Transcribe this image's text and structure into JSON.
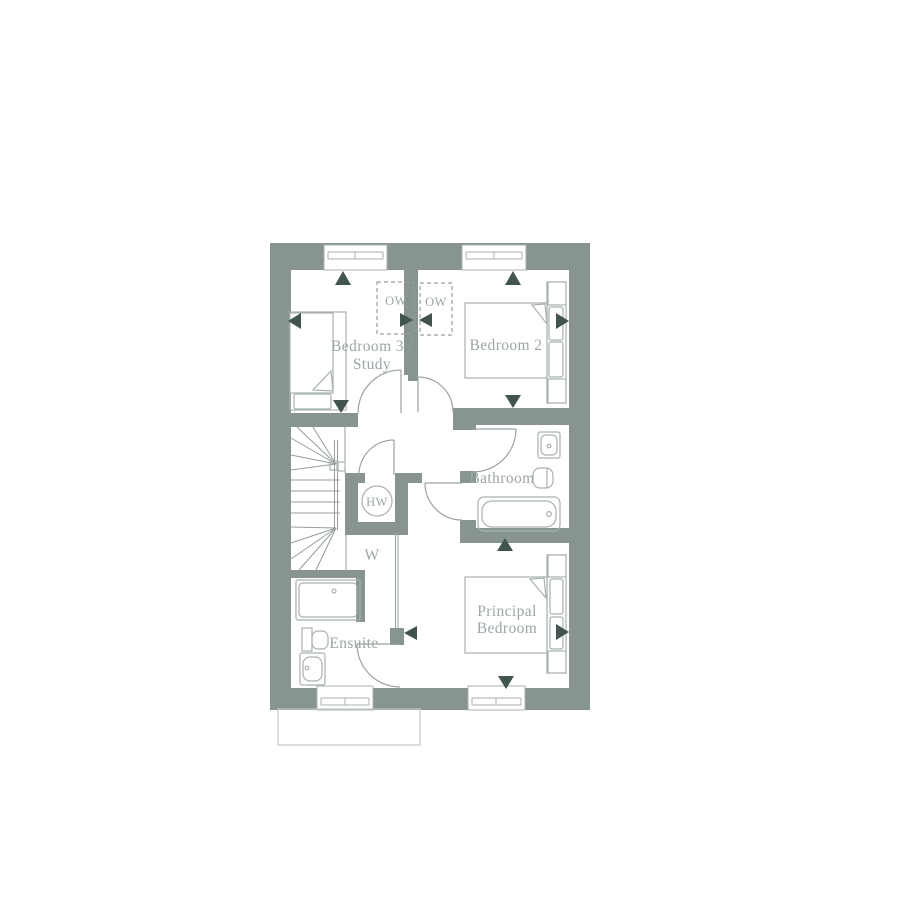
{
  "plan": {
    "name": "first-floor-plan",
    "rooms": {
      "bedroom3": {
        "label_line1": "Bedroom 3 /",
        "label_line2": "Study"
      },
      "bedroom2": {
        "label": "Bedroom 2"
      },
      "bathroom": {
        "label": "Bathroom"
      },
      "principal_bedroom": {
        "label_line1": "Principal",
        "label_line2": "Bedroom"
      },
      "ensuite": {
        "label": "Ensuite"
      },
      "wardrobe": {
        "label": "W"
      },
      "hot_water_cylinder": {
        "label": "HW"
      },
      "optional_wardrobe_left": {
        "label": "OW"
      },
      "optional_wardrobe_right": {
        "label": "OW"
      }
    }
  },
  "colors": {
    "wall": "#879490",
    "tri": "#41544f",
    "labelc": "#9ca7a1",
    "fixture": "#a9b2ad",
    "door": "#9aa49f",
    "stair": "#949f99",
    "dashline": "#96a19b",
    "faint": "#c4cac6",
    "bg": "#ffffff"
  }
}
